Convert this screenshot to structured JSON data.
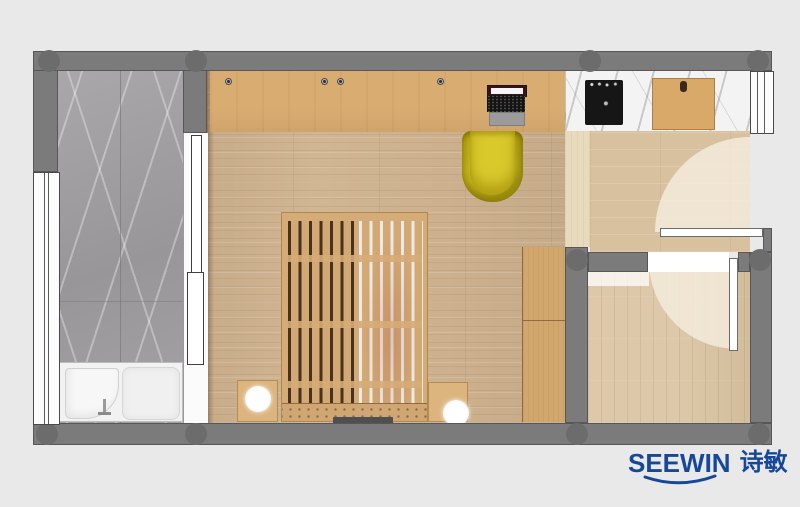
{
  "background_color": "#e9e9e9",
  "brand": {
    "name": "SEEWIN",
    "cjk": "诗敏",
    "color": "#16489A"
  },
  "palette": {
    "wall": "#7b7b7b",
    "wall_column": "#6c6c6c",
    "wood_floor": "#d1b694",
    "entry_floor": "#d8c19f",
    "inner_room_floor": "#ddc9a9",
    "hall_strip": "#e8dabd",
    "desk_wood": "#d9ad72",
    "bed_wood": "#d5ab77",
    "wardrobe_wood": "#d1a76d",
    "bathroom_marble": "#a3a0a3",
    "counter_marble": "#f4f3f4",
    "accent_yellow": "#d2c122",
    "cooktop_black": "#161616",
    "door_swing": "#f4eddd"
  },
  "plan": {
    "type": "apartment-floor-plan-top-view",
    "rooms": [
      {
        "name": "bathroom",
        "floor": "gray-marble",
        "position": "left"
      },
      {
        "name": "bedroom",
        "floor": "oak-plank",
        "position": "center"
      },
      {
        "name": "kitchenette",
        "floor": "white-marble-counter",
        "position": "top-right"
      },
      {
        "name": "entry-hall",
        "floor": "oak-plank",
        "position": "right"
      },
      {
        "name": "storage-room",
        "floor": "light-oak-plank",
        "position": "bottom-right"
      }
    ],
    "furniture": [
      {
        "name": "bathtub",
        "room": "bathroom"
      },
      {
        "name": "sliding-door",
        "room": "bathroom"
      },
      {
        "name": "window",
        "room": "bathroom",
        "wall": "left"
      },
      {
        "name": "desk-counter",
        "room": "bedroom"
      },
      {
        "name": "laptop",
        "room": "bedroom"
      },
      {
        "name": "desk-chair",
        "room": "bedroom",
        "color": "#d2c122"
      },
      {
        "name": "slatted-bed",
        "room": "bedroom"
      },
      {
        "name": "nightstand",
        "room": "bedroom",
        "side": "left"
      },
      {
        "name": "nightstand",
        "room": "bedroom",
        "side": "right"
      },
      {
        "name": "round-lamp",
        "room": "bedroom",
        "side": "left"
      },
      {
        "name": "round-lamp",
        "room": "bedroom",
        "side": "right"
      },
      {
        "name": "wardrobe",
        "room": "bedroom"
      },
      {
        "name": "induction-cooktop",
        "room": "kitchenette"
      },
      {
        "name": "cutting-board",
        "room": "kitchenette"
      },
      {
        "name": "hinged-door",
        "room": "entry-hall"
      },
      {
        "name": "window",
        "room": "entry-hall",
        "wall": "right"
      },
      {
        "name": "hinged-door",
        "room": "storage-room"
      }
    ]
  }
}
